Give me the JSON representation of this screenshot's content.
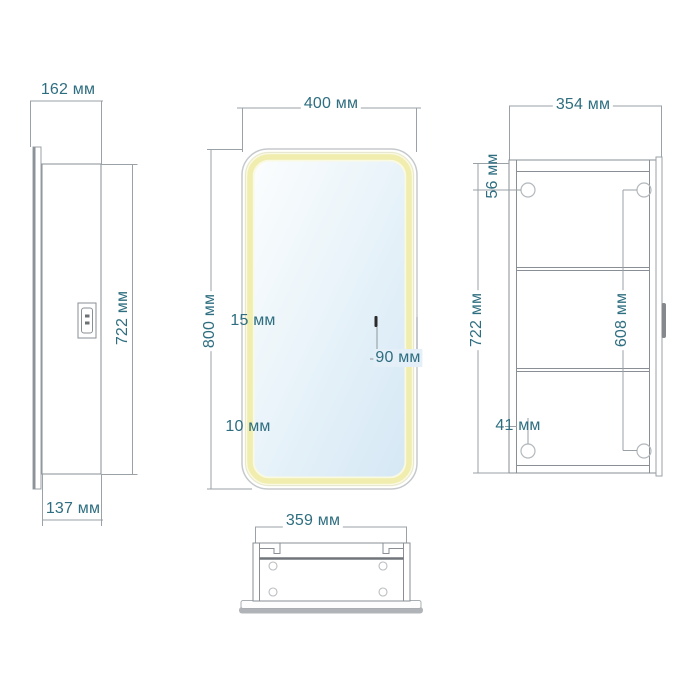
{
  "drawing": {
    "type": "furniture technical drawing — LED mirror cabinet, four orthographic views",
    "units": "мм",
    "labels": {
      "side_depth_top": "162 мм",
      "side_height": "722 мм",
      "side_depth_bottom": "137 мм",
      "front_width": "400 мм",
      "front_height": "800 мм",
      "front_led_strip": "15 мм",
      "front_bottom_edge": "10 мм",
      "front_sensor_offset": "90 мм",
      "back_width": "354 мм",
      "back_hole_top_offset": "56 мм",
      "back_height": "722 мм",
      "back_hole_spacing": "608 мм",
      "back_hole_bottom_offset": "41 мм",
      "top_width": "359 мм"
    },
    "colors": {
      "dimension_text": "#2e6e80",
      "dimension_line": "#9aa1a7",
      "outline": "#898f94",
      "led_strip": "#f0edae",
      "mirror_tint": "#d9eaf6",
      "background": "#ffffff"
    }
  }
}
